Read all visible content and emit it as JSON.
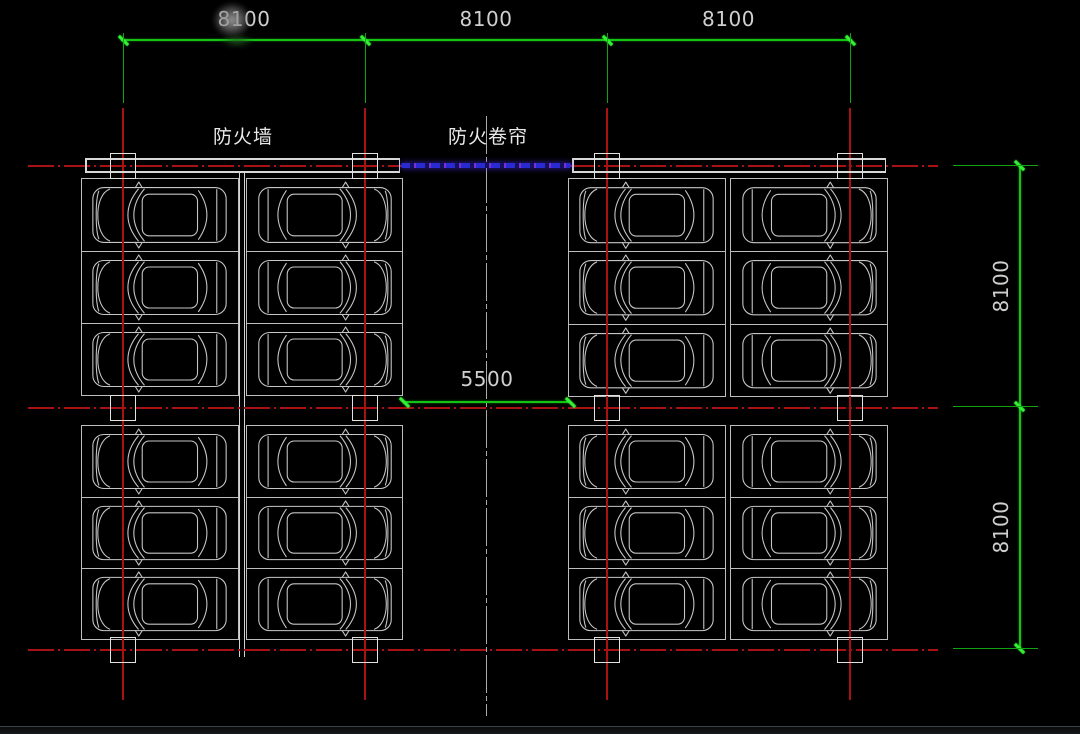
{
  "drawing": {
    "type": "underground-parking-garage-floor-plan",
    "background": "#000000"
  },
  "labels": {
    "fire_wall": "防火墙",
    "fire_shutter": "防火卷帘"
  },
  "dims": {
    "top": [
      {
        "label": "8100",
        "value": 8100
      },
      {
        "label": "8100",
        "value": 8100
      },
      {
        "label": "8100",
        "value": 8100
      }
    ],
    "right": [
      {
        "label": "8100",
        "value": 8100
      },
      {
        "label": "8100",
        "value": 8100
      }
    ],
    "aisle": {
      "label": "5500",
      "value": 5500
    }
  },
  "parking": {
    "quadrants": 4,
    "columns_per_quadrant": 2,
    "rows_per_column": 3,
    "total_stalls": 24
  },
  "colors": {
    "dimension_green": "#14c314",
    "grid_red": "#a81212",
    "wall_white": "#d9d9d9",
    "stall_gray": "#c6c6c6",
    "shutter_blue": "#3232d8",
    "text_gray": "#cfcfcf"
  }
}
